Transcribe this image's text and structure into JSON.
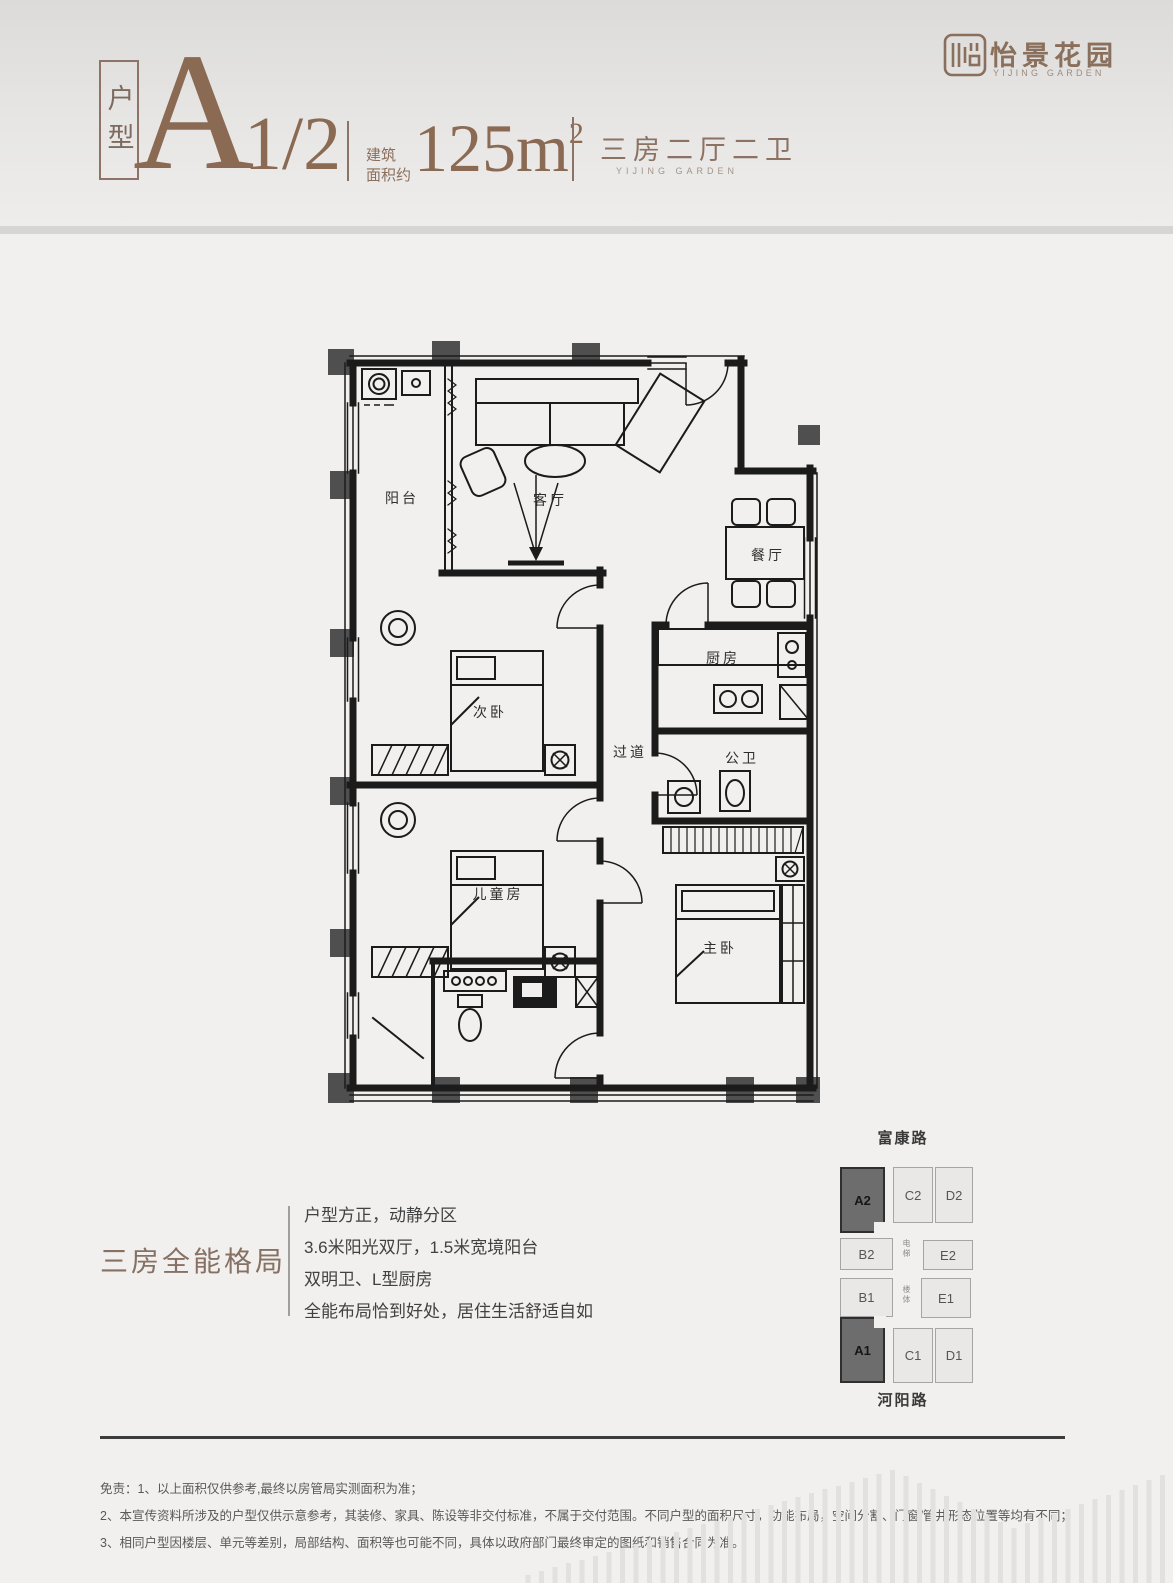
{
  "accent_color": "#8a6f5c",
  "page_bg": "#f1f0ee",
  "logo": {
    "name": "怡景花园",
    "sub": "YIJING GARDEN"
  },
  "header": {
    "unit_tag": "户型",
    "unit_code": "A",
    "unit_variant": "1/2",
    "area_label_1": "建筑",
    "area_label_2": "面积约",
    "area_value": "125m",
    "area_exp": "2",
    "rooms_summary": "三房二厅二卫",
    "rooms_summary_en": "YIJING GARDEN"
  },
  "floorplan": {
    "labels": {
      "balcony": "阳台",
      "living": "客厅",
      "dining": "餐厅",
      "bedroom2": "次卧",
      "hall": "过道",
      "kitchen": "厨房",
      "bath": "公卫",
      "kids": "儿童房",
      "master": "主卧"
    }
  },
  "features": {
    "headline": "三房全能格局",
    "lines": [
      "户型方正，动静分区",
      "3.6米阳光双厅，1.5米宽境阳台",
      "双明卫、L型厨房",
      "全能布局恰到好处，居住生活舒适自如"
    ]
  },
  "sitemap": {
    "road_top": "富康路",
    "road_bottom": "河阳路",
    "core_labels": {
      "elevator": "电梯",
      "stairs": "楼体"
    },
    "units": [
      {
        "id": "A2",
        "highlight": true
      },
      {
        "id": "C2",
        "highlight": false
      },
      {
        "id": "D2",
        "highlight": false
      },
      {
        "id": "B2",
        "highlight": false
      },
      {
        "id": "E2",
        "highlight": false
      },
      {
        "id": "B1",
        "highlight": false
      },
      {
        "id": "E1",
        "highlight": false
      },
      {
        "id": "A1",
        "highlight": true
      },
      {
        "id": "C1",
        "highlight": false
      },
      {
        "id": "D1",
        "highlight": false
      }
    ]
  },
  "disclaimer": {
    "lines": [
      "免责：1、以上面积仅供参考,最终以房管局实测面积为准；",
      "2、本宣传资料所涉及的户型仅供示意参考，其装修、家具、陈设等非交付标准，不属于交付范围。不同户型的面积尺寸，功能布局，空间分割、门窗/管井形态位置等均有不同；",
      "3、相同户型因楼层、单元等差别，局部结构、面积等也可能不同，具体以政府部门最终审定的图纸和销售合同为准。"
    ]
  }
}
